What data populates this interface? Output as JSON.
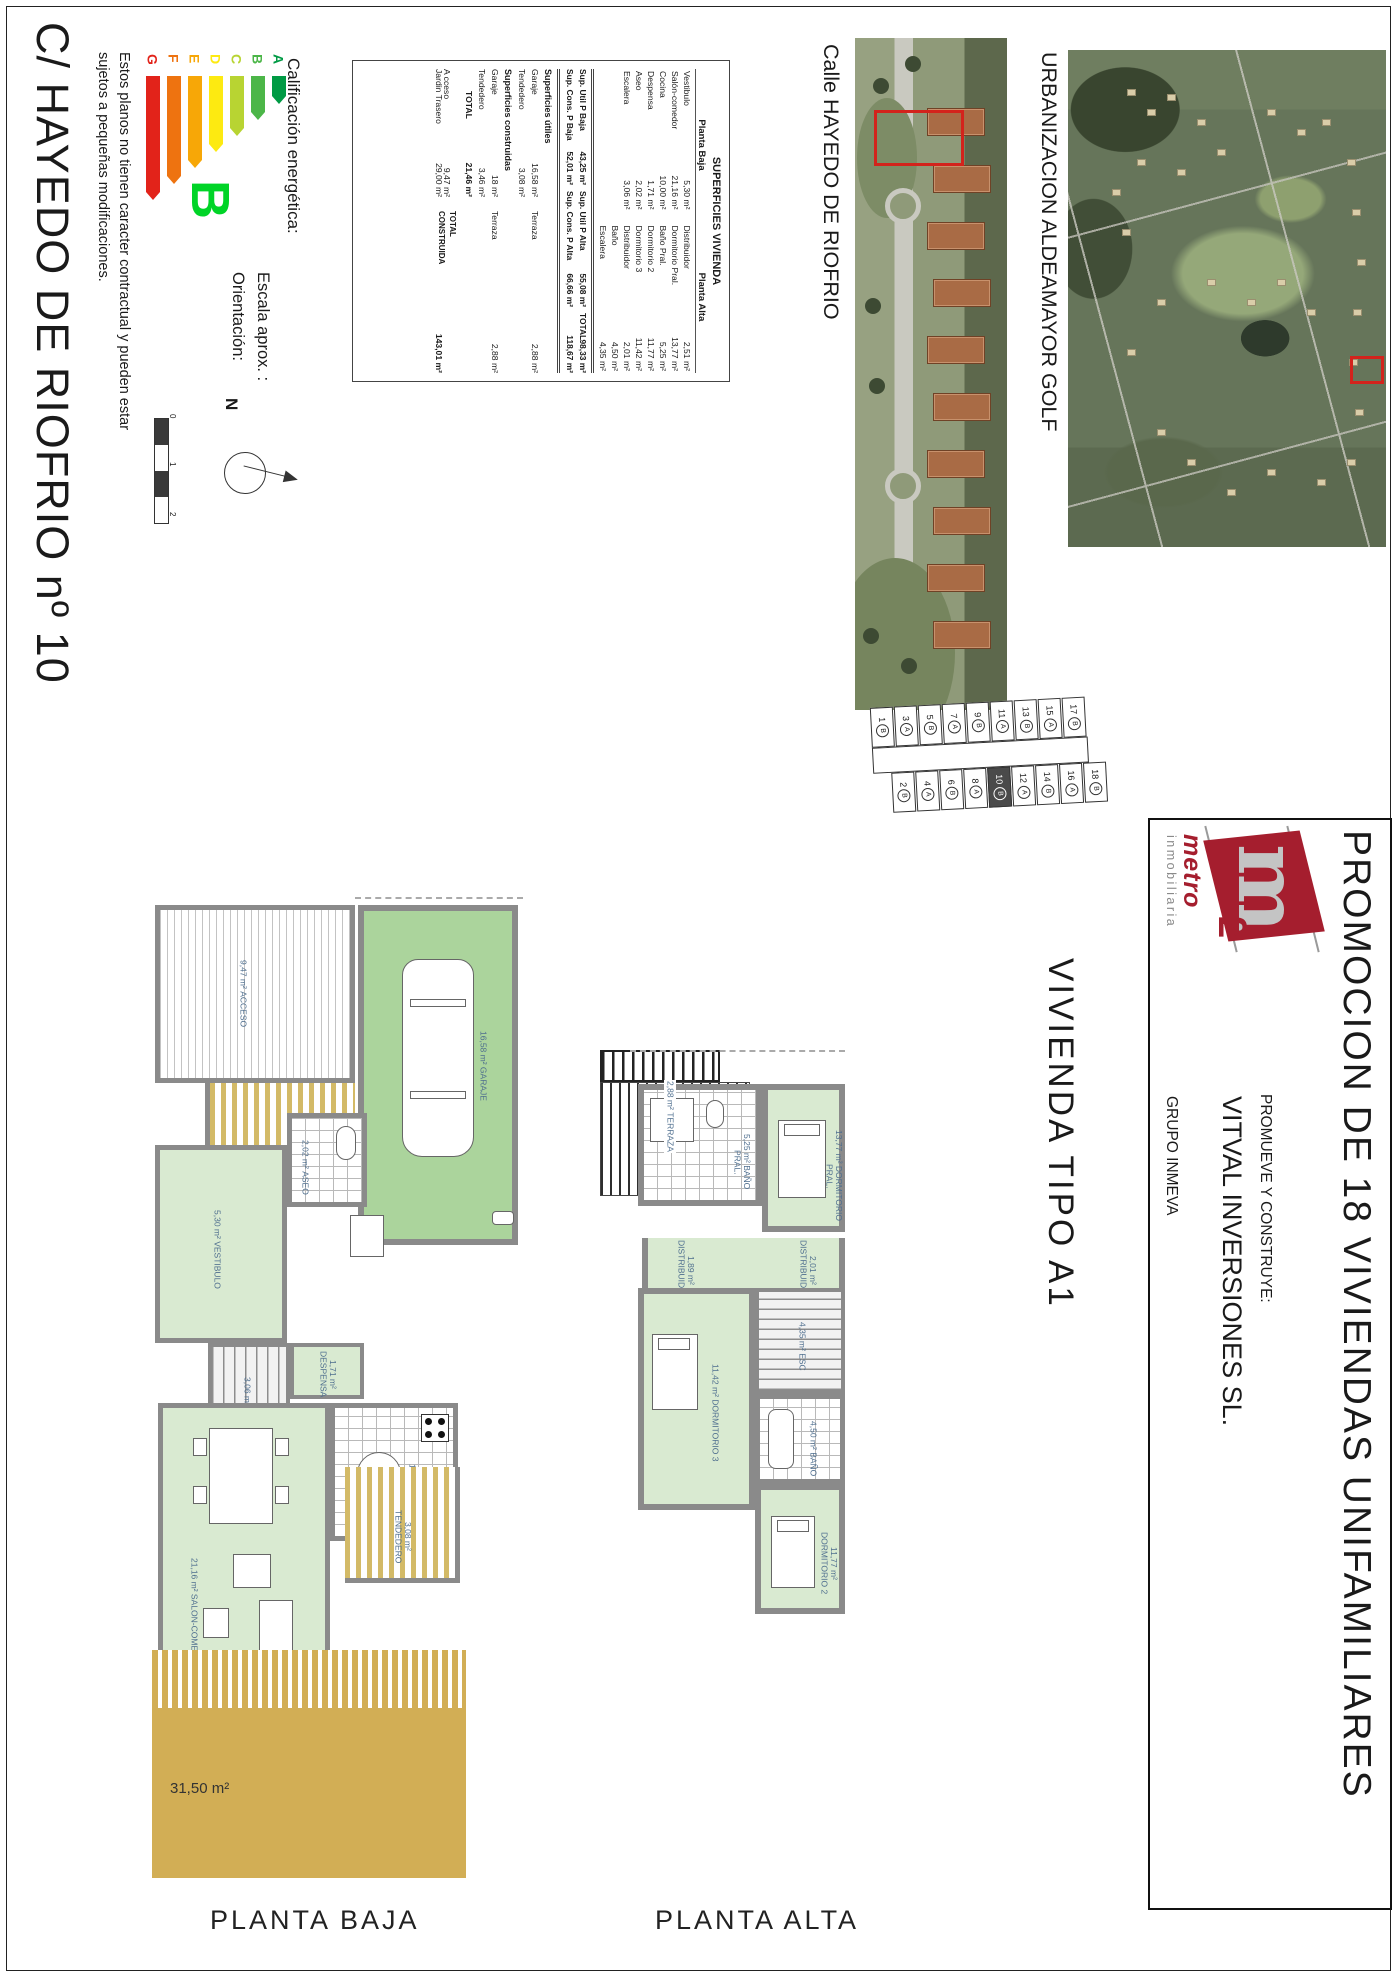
{
  "sheet": {
    "title": "C/ HAYEDO DE RIOFRIO nº 10",
    "disclaimer_line1": "Estos planos no tienen caracter contractual y pueden estar",
    "disclaimer_line2": "sujetos a pequeñas modificaciones."
  },
  "energy": {
    "label": "Calificación energética:",
    "rating": "B",
    "rating_color": "#00d427",
    "levels": [
      {
        "letter": "A",
        "color": "#009a44",
        "len": 20
      },
      {
        "letter": "B",
        "color": "#4cb648",
        "len": 36
      },
      {
        "letter": "C",
        "color": "#b8d432",
        "len": 52
      },
      {
        "letter": "D",
        "color": "#fdea11",
        "len": 68
      },
      {
        "letter": "E",
        "color": "#f7a707",
        "len": 84
      },
      {
        "letter": "F",
        "color": "#ee7310",
        "len": 100
      },
      {
        "letter": "G",
        "color": "#e2231a",
        "len": 116
      }
    ]
  },
  "orientation": {
    "orientacion_label": "Orientación:",
    "escala_label": "Escala aprox. :",
    "north_letter": "N",
    "scale_ticks": [
      "0",
      "1",
      "2"
    ]
  },
  "surfaces_table": {
    "title": "SUPERFICIES VIVIENDA",
    "col_baja": "Planta Baja",
    "col_alta": "Planta Alta",
    "rows": [
      {
        "bn": "Vestibulo",
        "bv": "5,30 m²",
        "an": "Distribuidor",
        "av": "2,51 m²"
      },
      {
        "bn": "Salón-comedor",
        "bv": "21,16 m²",
        "an": "Dormitorio Pral.",
        "av": "13,77 m²"
      },
      {
        "bn": "Cocina",
        "bv": "10,00 m²",
        "an": "Baño Pral.",
        "av": "5,25 m²"
      },
      {
        "bn": "Despensa",
        "bv": "1,71 m²",
        "an": "Dormitorio 2",
        "av": "11,77 m²"
      },
      {
        "bn": "Aseo",
        "bv": "2,02 m²",
        "an": "Dormitorio 3",
        "av": "11,42 m²"
      },
      {
        "bn": "Escalera",
        "bv": "3,06 m²",
        "an": "Distribuidor",
        "av": "2,01 m²"
      },
      {
        "bn": "",
        "bv": "",
        "an": "Baño",
        "av": "4,50 m²"
      },
      {
        "bn": "",
        "bv": "",
        "an": "Escalera",
        "av": "4,35 m²"
      }
    ],
    "totals": {
      "util_baja_label": "Sup. Util P Baja",
      "util_baja": "43,25 m²",
      "util_alta_label": "Sup. Util P Alta",
      "util_alta": "55,08 m²",
      "total_label": "TOTAL",
      "util_total": "98,33 m²",
      "cons_baja_label": "Sup. Cons. P Baja",
      "cons_baja": "52,01 m²",
      "cons_alta_label": "Sup. Cons. P Alta",
      "cons_alta": "66,66 m²",
      "cons_total": "118,67 m²"
    },
    "annex": {
      "utiles_header": "Superficies útiles",
      "utiles_r1": {
        "n": "Garaje",
        "v": "16,58 m²",
        "n2": "Terraza",
        "v2": "2,88 m²"
      },
      "utiles_r2": {
        "n": "Tendedero",
        "v": "3,08 m²"
      },
      "construidas_header": "Superficies construidas",
      "cons_r1": {
        "n": "Garaje",
        "v": "18 m²",
        "n2": "Terraza",
        "v2": "2,88 m²"
      },
      "cons_r2": {
        "n": "Tendedero",
        "v": "3,46 m²"
      },
      "total_label": "TOTAL",
      "total_value": "21,46 m²",
      "acceso_label": "A cceso",
      "acceso_value": "9,47 m²",
      "jardin_label": "Jardin Trasero",
      "jardin_value": "29,00 m²",
      "total_construida_label": "TOTAL CONSTRUIDA",
      "total_construida_value": "143,01 m²"
    }
  },
  "photos": {
    "calle_label": "Calle HAYEDO DE RIOFRIO",
    "urbanizacion_label": "URBANIZACION ALDEAMAYOR GOLF",
    "marker_color": "#d3231c"
  },
  "site_plan": {
    "highlighted": "10",
    "plots": [
      {
        "n": "1",
        "t": "B"
      },
      {
        "n": "2",
        "t": "B"
      },
      {
        "n": "3",
        "t": "A"
      },
      {
        "n": "4",
        "t": "A"
      },
      {
        "n": "5",
        "t": "B"
      },
      {
        "n": "6",
        "t": "B"
      },
      {
        "n": "7",
        "t": "A"
      },
      {
        "n": "8",
        "t": "A"
      },
      {
        "n": "9",
        "t": "B"
      },
      {
        "n": "10",
        "t": "B"
      },
      {
        "n": "11",
        "t": "A"
      },
      {
        "n": "12",
        "t": "A"
      },
      {
        "n": "13",
        "t": "B"
      },
      {
        "n": "14",
        "t": "B"
      },
      {
        "n": "15",
        "t": "A"
      },
      {
        "n": "16",
        "t": "A"
      },
      {
        "n": "17",
        "t": "B"
      },
      {
        "n": "18",
        "t": "B"
      }
    ]
  },
  "promo": {
    "title": "PROMOCION DE 18 VIVIENDAS UNIFAMILIARES",
    "promueve": "PROMUEVE Y CONSTRUYE:",
    "company": "VITVAL INVERSIONES SL.",
    "grupo": "GRUPO INMEVA"
  },
  "logo": {
    "m": "m",
    "sup": "2",
    "metro": "metro",
    "inmobiliaria": "inmobiliaria",
    "brand_red": "#a51e2e"
  },
  "vivienda_label": "VIVIENDA TIPO A1",
  "plans": {
    "baja_label": "PLANTA BAJA",
    "alta_label": "PLANTA ALTA",
    "jardin_area": "31,50 m²",
    "baja_rooms": {
      "acceso": {
        "value": "9,47 m²",
        "name": "ACCESO"
      },
      "garaje": {
        "value": "16,58 m²",
        "name": "GARAJE"
      },
      "vestibulo": {
        "value": "5,30 m²",
        "name": "VESTIBULO"
      },
      "aseo": {
        "value": "2,02 m²",
        "name": "ASEO"
      },
      "despensa": {
        "value": "1,71 m²",
        "name": "DESPENSA"
      },
      "escalera": {
        "value": "3,06 m²",
        "name": "ESCALERA"
      },
      "cocina": {
        "value": "10,00 m²",
        "name": "COCINA"
      },
      "salon": {
        "value": "21,16 m²",
        "name": "SALON-COMEDOR"
      },
      "tendedero": {
        "value": "3,08 m²",
        "name": "TENDEDERO"
      }
    },
    "alta_rooms": {
      "banopral": {
        "value": "5,25 m²",
        "name": "BAÑO PRAL."
      },
      "dormpral": {
        "value": "13,77 m²",
        "name": "DORMITORIO PRAL."
      },
      "distribuidor1": {
        "value": "1,89 m²",
        "name": "DISTRIBUIDOR"
      },
      "distribuidor2": {
        "value": "2,01 m²",
        "name": "DISTRIBUIDOR"
      },
      "dorm3": {
        "value": "11,42 m²",
        "name": "DORMITORIO 3"
      },
      "dorm2": {
        "value": "11,77 m²",
        "name": "DORMITORIO 2"
      },
      "bano": {
        "value": "4,50 m²",
        "name": "BAÑO"
      },
      "escalera": {
        "value": "4,35 m²",
        "name": "ESC"
      },
      "terraza": {
        "value": "2,88 m²",
        "name": "TERRAZA"
      }
    }
  },
  "palette": {
    "wall_gray": "#8a8a8a",
    "room_green": "#d9ead1",
    "garage_green": "#abd49c",
    "garden_yellow": "#d2ae55",
    "label_blue": "#4e6e8e"
  }
}
